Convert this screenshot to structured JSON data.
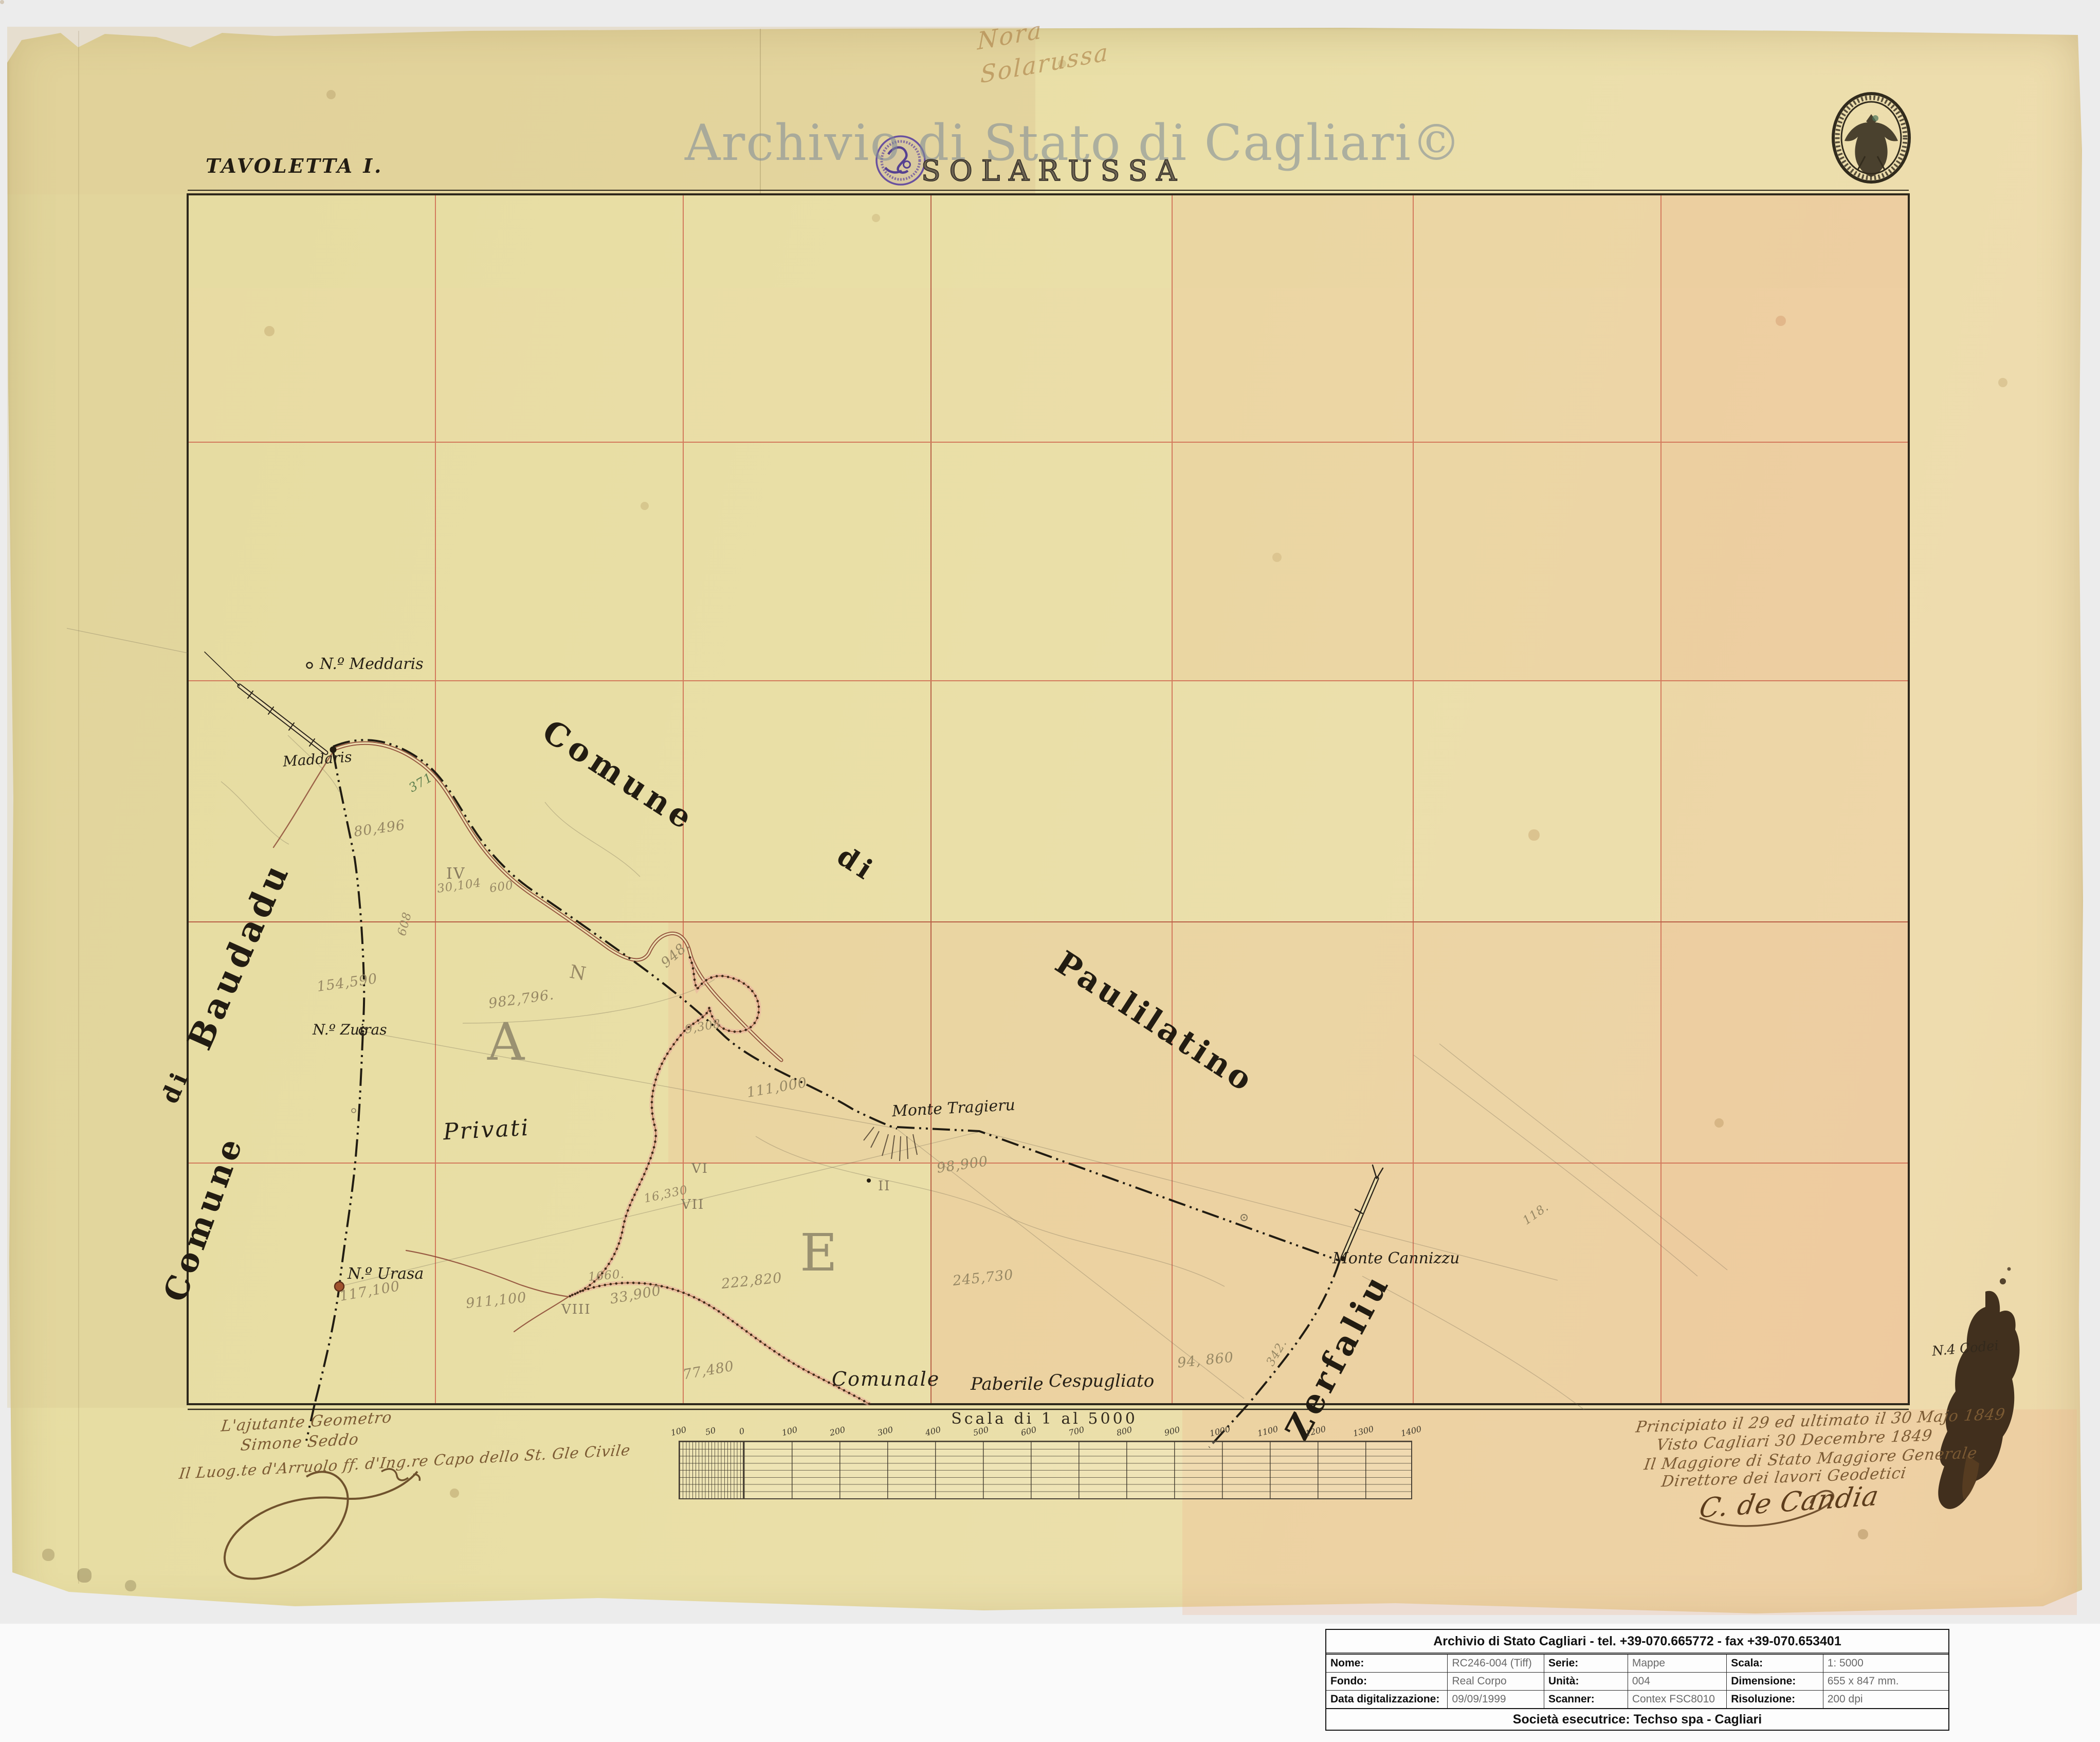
{
  "header": {
    "sheet_label": "TAVOLETTA I.",
    "watermark": "Archivio di Stato di Cagliari©",
    "map_title": "SOLARUSSA",
    "pencil_note_line1": "Nora",
    "pencil_note_line2": "Solarussa"
  },
  "map": {
    "regions": {
      "comune_north": "Comune",
      "di_north": "di",
      "paulilatino": "Paulilatino",
      "comune_west": "Comune",
      "di_west": "di",
      "baudadu": "Baudadu",
      "zerfaliu": "Zerfaliu",
      "privati": "Privati",
      "comunale": "Comunale",
      "paberile": "Paberile",
      "cespugliato": "Cespugliato"
    },
    "section_letters": {
      "a": "A",
      "e": "E",
      "n": "N"
    },
    "places": {
      "n_meddaris": "N.º Meddaris",
      "maddaris": "Maddaris",
      "n_zuiras": "N.º Zuiras",
      "n_urasa": "N.º Urasa",
      "monte_tragieru": "Monte Tragieru",
      "monte_cannizzu": "Monte Cannizzu",
      "n4_codei": "N.4 Codei"
    },
    "numerals": {
      "ii": "II",
      "iv": "IV",
      "vi": "VI",
      "vii": "VII",
      "viii": "VIII"
    },
    "measurements": {
      "m80496": "80,496",
      "m948": "948.",
      "m9308": "9,308",
      "m982796": "982,796.",
      "m154590": "154,590",
      "m111000": "111,000",
      "m98900": "98,900",
      "m16330": "16,330",
      "m117100": "117,100",
      "m911100": "911,100",
      "m33900": "33,900",
      "m222820": "222,820",
      "m245730": "245,730",
      "m94860": "94, 860",
      "m77480": "77,480",
      "m1660": "1660.",
      "m30104": "30,104",
      "m600": "600",
      "m608": "608",
      "m342": "342.",
      "m371": "371",
      "m118": "118."
    }
  },
  "scalebar": {
    "title": "Scala di 1 al 5000",
    "ticks": [
      "100",
      "50",
      "0",
      "100",
      "200",
      "300",
      "400",
      "500",
      "600",
      "700",
      "800",
      "900",
      "1000",
      "1100",
      "1200",
      "1300",
      "1400"
    ]
  },
  "notes_left": {
    "line1": "L'ajutante Geometro",
    "line2": "Simone Seddo",
    "line3": "Il Luog.te d'Arruolo ff. d'Ing.re Capo dello St. Gle Civile"
  },
  "notes_right": {
    "line1": "Principiato il 29 ed ultimato il 30 Majo 1849",
    "line2": "Visto Cagliari 30 Decembre 1849",
    "line3": "Il Maggiore di Stato Maggiore Generale",
    "line4": "Direttore dei lavori Geodetici",
    "signature": "C. de Candia"
  },
  "info_table": {
    "header": "Archivio di Stato Cagliari - tel. +39-070.665772 - fax +39-070.653401",
    "rows": [
      {
        "label1": "Nome:",
        "value1": "RC246-004 (Tiff)",
        "label2": "Serie:",
        "value2": "Mappe",
        "label3": "Scala:",
        "value3": "1: 5000"
      },
      {
        "label1": "Fondo:",
        "value1": "Real Corpo",
        "label2": "Unità:",
        "value2": "004",
        "label3": "Dimensione:",
        "value3": "655 x 847 mm."
      },
      {
        "label1": "Data digitalizzazione:",
        "value1": "09/09/1999",
        "label2": "Scanner:",
        "value2": "Contex FSC8010",
        "label3": "Risoluzione:",
        "value3": "200 dpi"
      }
    ],
    "footer": "Società esecutrice: Techso spa - Cagliari"
  },
  "colors": {
    "paper": "#e9dfa6",
    "grid_red": "#cf6950",
    "ink_black": "#262016",
    "ink_brown": "#7b5a33",
    "pencil": "#978864",
    "stamp_purple": "#5f46a0",
    "watermark_gray": "#808c98"
  }
}
